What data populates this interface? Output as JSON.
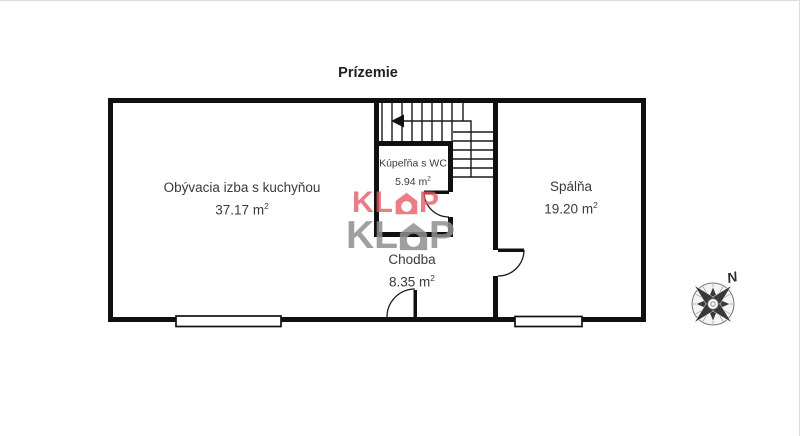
{
  "page": {
    "title": "Prízemie"
  },
  "rooms": {
    "living": {
      "name": "Obývacia izba s kuchyňou",
      "area_value": "37.17 m",
      "area_sup": "2"
    },
    "bathroom": {
      "name": "Kúpeľňa s WC",
      "area_value": "5.94 m",
      "area_sup": "2"
    },
    "bedroom": {
      "name": "Spálňa",
      "area_value": "19.20 m",
      "area_sup": "2"
    },
    "hallway": {
      "name": "Chodba",
      "area_value": "8.35 m",
      "area_sup": "2"
    }
  },
  "watermark": {
    "brand_full": "KLOP",
    "brand_part1": "KL",
    "brand_part2": "P",
    "red_color": "#e45864",
    "gray_color": "#8f8f8f"
  },
  "compass": {
    "north_label": "N"
  },
  "colors": {
    "wall": "#101010",
    "label_text": "#3a3a3a",
    "title_text": "#1f1f1f"
  }
}
